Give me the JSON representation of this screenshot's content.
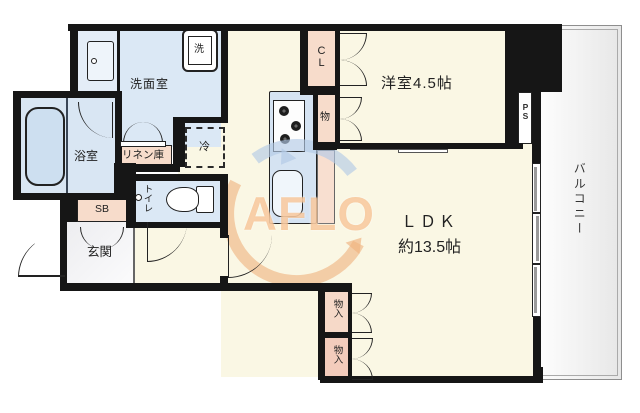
{
  "floorplan": {
    "rooms": {
      "washroom": "洗面室",
      "bathroom": "浴室",
      "western_room": "洋室4.5帖",
      "ldk_line1": "ＬＤＫ",
      "ldk_line2": "約13.5帖",
      "entrance": "玄関",
      "toilet": "トイレ",
      "balcony": "バルコニー"
    },
    "storage": {
      "closet": "CL",
      "small_storage": "物",
      "storage_1": "物入",
      "storage_2": "物入",
      "linen": "リネン庫",
      "shoe_box": "SB",
      "refrigerator": "冷",
      "pipe_space": "PS",
      "washer": "洗"
    },
    "watermark": "AFLO",
    "colors": {
      "wall": "#161616",
      "wet_room_blue": "#dbe8f5",
      "floor_cream": "#faf7e4",
      "closet_peach": "#f7dccb",
      "entrance_gray": "#f0f0f2",
      "watermark_orange": "#f0a964",
      "watermark_blue": "#b4cbe7"
    }
  }
}
